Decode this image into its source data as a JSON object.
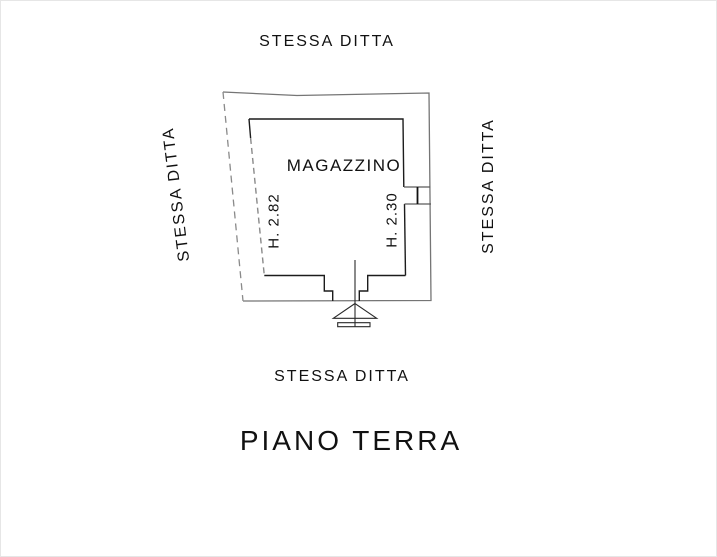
{
  "drawing": {
    "title": "PIANO TERRA",
    "room": {
      "name": "MAGAZZINO",
      "height_left": "H. 2.82",
      "height_right": "H. 2.30"
    },
    "adjacent": {
      "top": "STESSA DITTA",
      "left": "STESSA DITTA",
      "right": "STESSA DITTA",
      "bottom": "STESSA DITTA"
    }
  },
  "colors": {
    "background": "#ffffff",
    "ink": "#111111",
    "wall_outer_gray": "#757575",
    "wall_inner_black": "#1c1c1c",
    "dashed_gray": "#8a8a8a"
  }
}
